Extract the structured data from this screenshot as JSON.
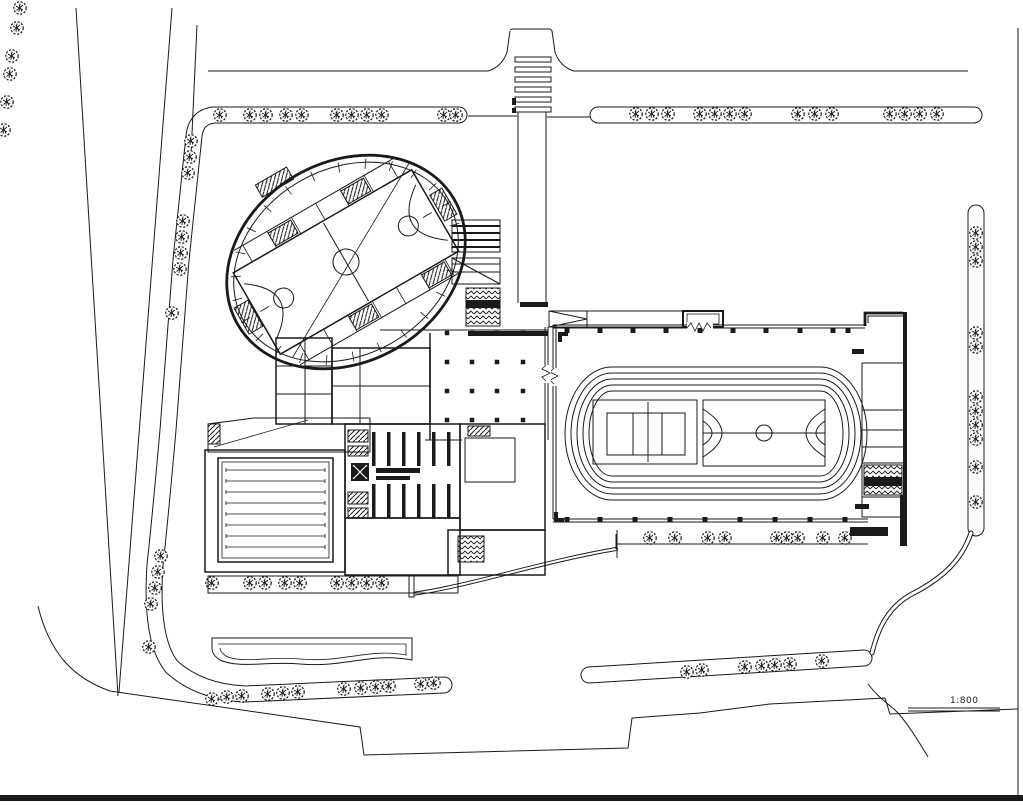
{
  "document": {
    "type": "architectural-site-plan",
    "background_color": "#ffffff",
    "line_color": "#1a1a1a"
  },
  "annotations": {
    "scale_text": "1:800"
  },
  "zebra_crossing": {
    "x": 515,
    "w": 36,
    "h": 5,
    "ys": [
      57,
      67,
      77,
      87,
      97,
      107
    ]
  },
  "plaza_grid": {
    "xs": [
      447,
      472,
      497,
      523
    ],
    "ys": [
      333,
      362,
      391,
      420
    ],
    "dot": 4.5
  },
  "field_wall_dots": {
    "top_y": 328,
    "top_xs": [
      567,
      600,
      633,
      666,
      700,
      733,
      766,
      800,
      833,
      848
    ],
    "bottom_y": 517,
    "bottom_xs": [
      567,
      600,
      635,
      670,
      705,
      740,
      775,
      810,
      845
    ]
  },
  "oval_ticks": {
    "count": 26,
    "cx": 346,
    "cy": 262,
    "outer_rx": 121,
    "outer_ry": 96.5,
    "inner_rx": 111,
    "inner_ry": 86.5
  },
  "track": {
    "x1": 612,
    "x2": 820,
    "top": 367,
    "bottom": 500,
    "end_rx": 47,
    "lane_offsets": [
      0,
      6,
      12,
      18,
      24
    ]
  },
  "pool": {
    "x1": 226,
    "x2": 325,
    "y_start": 470,
    "y_step": 11,
    "lane_count": 8
  },
  "benches": {
    "xs": [
      372,
      387,
      402,
      417,
      432,
      447
    ],
    "w": 3.5,
    "rows": [
      {
        "y": 432,
        "h": 34
      },
      {
        "y": 484,
        "h": 34
      }
    ]
  },
  "trees": {
    "groups": [
      {
        "name": "top-left-strip",
        "pts": [
          [
            220,
            115
          ],
          [
            250,
            115
          ],
          [
            266,
            115
          ],
          [
            286,
            115
          ],
          [
            302,
            115
          ],
          [
            337,
            115
          ],
          [
            352,
            115
          ],
          [
            367,
            115
          ],
          [
            382,
            115
          ],
          [
            444,
            115
          ],
          [
            456,
            115
          ]
        ]
      },
      {
        "name": "left-strip",
        "pts": [
          [
            191,
            141
          ],
          [
            190,
            157
          ],
          [
            188,
            173
          ],
          [
            183,
            221
          ],
          [
            182,
            237
          ],
          [
            181,
            253
          ],
          [
            180,
            269
          ],
          [
            172,
            313
          ],
          [
            161,
            556
          ],
          [
            158,
            572
          ],
          [
            155,
            588
          ],
          [
            151,
            604
          ],
          [
            149,
            647
          ]
        ]
      },
      {
        "name": "far-left-edge",
        "pts": [
          [
            20,
            8
          ],
          [
            17,
            28
          ],
          [
            12,
            56
          ],
          [
            10,
            74
          ],
          [
            7,
            102
          ],
          [
            4,
            130
          ]
        ]
      },
      {
        "name": "bottom-left-strip",
        "pts": [
          [
            212,
            699
          ],
          [
            227,
            697
          ],
          [
            242,
            696
          ],
          [
            268,
            694
          ],
          [
            283,
            693
          ],
          [
            298,
            692
          ],
          [
            344,
            689
          ],
          [
            361,
            688
          ],
          [
            376,
            687
          ],
          [
            389,
            686
          ],
          [
            421,
            684
          ],
          [
            434,
            683
          ]
        ]
      },
      {
        "name": "bottom-mid-strip",
        "pts": [
          [
            687,
            672
          ],
          [
            702,
            670
          ],
          [
            745,
            667
          ],
          [
            762,
            666
          ],
          [
            775,
            665
          ],
          [
            790,
            664
          ],
          [
            822,
            661
          ]
        ]
      },
      {
        "name": "top-right-strip",
        "pts": [
          [
            636,
            114
          ],
          [
            652,
            114
          ],
          [
            668,
            114
          ],
          [
            700,
            114
          ],
          [
            715,
            114
          ],
          [
            730,
            114
          ],
          [
            745,
            114
          ],
          [
            798,
            114
          ],
          [
            815,
            114
          ],
          [
            832,
            114
          ],
          [
            890,
            114
          ],
          [
            905,
            114
          ],
          [
            920,
            114
          ],
          [
            937,
            114
          ]
        ]
      },
      {
        "name": "right-strip",
        "pts": [
          [
            976,
            233
          ],
          [
            976,
            247
          ],
          [
            976,
            261
          ],
          [
            976,
            333
          ],
          [
            976,
            347
          ],
          [
            976,
            397
          ],
          [
            976,
            411
          ],
          [
            976,
            425
          ],
          [
            976,
            439
          ],
          [
            976,
            467
          ],
          [
            976,
            502
          ]
        ]
      },
      {
        "name": "field-south-row",
        "pts": [
          [
            650,
            538
          ],
          [
            675,
            538
          ],
          [
            708,
            538
          ],
          [
            725,
            538
          ],
          [
            777,
            538
          ],
          [
            787,
            538
          ],
          [
            798,
            538
          ],
          [
            823,
            538
          ],
          [
            845,
            538
          ]
        ]
      },
      {
        "name": "complex-south-row",
        "pts": [
          [
            212,
            583
          ],
          [
            250,
            583
          ],
          [
            265,
            583
          ],
          [
            285,
            583
          ],
          [
            300,
            583
          ],
          [
            337,
            583
          ],
          [
            352,
            583
          ],
          [
            367,
            583
          ],
          [
            382,
            583
          ]
        ]
      }
    ]
  }
}
